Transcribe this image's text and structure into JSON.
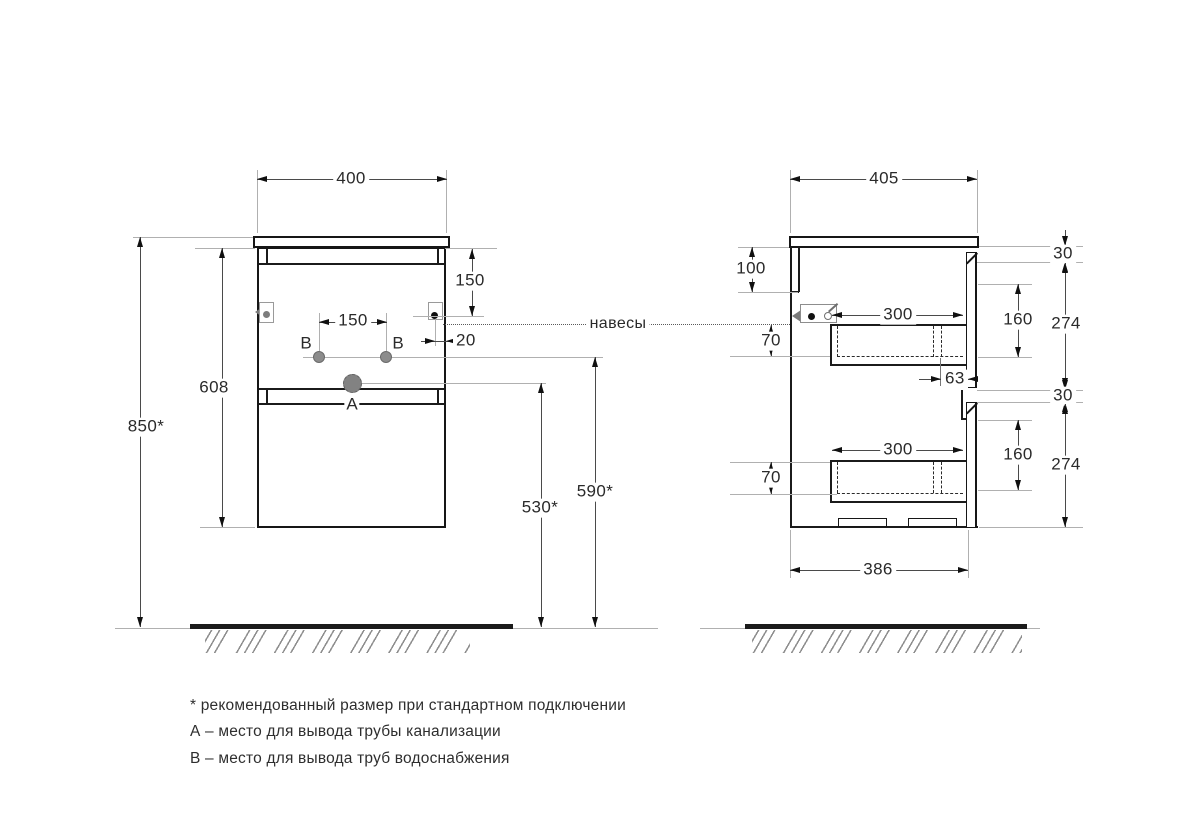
{
  "front": {
    "width": "400",
    "hanger_offset": "150",
    "b_spacing": "150",
    "hanger_edge": "20",
    "body_height": "608",
    "mount_height": "850*",
    "drain_height": "530*",
    "supply_height": "590*",
    "label_a": "А",
    "label_b": "В"
  },
  "side": {
    "width": "405",
    "back_top": "100",
    "drawer_depth": "300",
    "front_gap": "30",
    "drawer_front": "160",
    "panel_height": "274",
    "drawer_box": "70",
    "siphon_offset": "63",
    "bottom_width": "386"
  },
  "hangers_label": "навесы",
  "legend": {
    "note": "* рекомендованный размер при стандартном подключении",
    "a": "А – место для вывода трубы канализации",
    "b": "В – место для вывода труб водоснабжения"
  }
}
